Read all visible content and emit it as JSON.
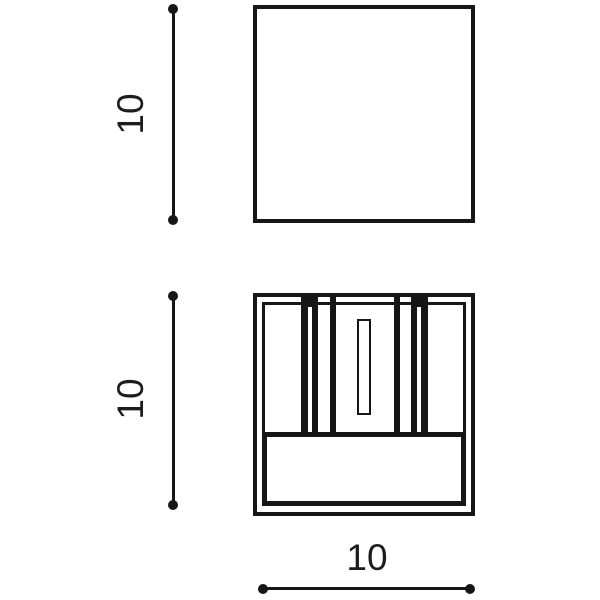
{
  "diagram": {
    "type": "technical-dimension-drawing",
    "subject": "square cube wall-light fixture, two orthographic views",
    "views": [
      {
        "id": "front-view",
        "description": "plain square outline (front face)"
      },
      {
        "id": "plan-view",
        "description": "square body with inner frame, two double louver bars, central lamp box with slot, and lower panel"
      }
    ],
    "dimensions": [
      {
        "id": "front-height",
        "value": "10",
        "orientation": "vertical"
      },
      {
        "id": "plan-height",
        "value": "10",
        "orientation": "vertical"
      },
      {
        "id": "plan-width",
        "value": "10",
        "orientation": "horizontal"
      }
    ],
    "colors": {
      "line": "#161616",
      "text": "#1c1c1c",
      "background": "#ffffff"
    }
  }
}
